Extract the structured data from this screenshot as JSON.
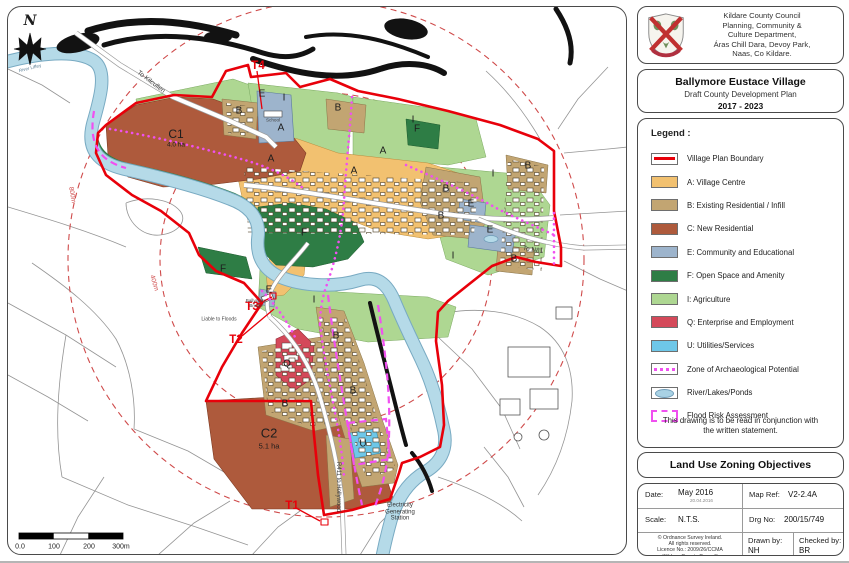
{
  "header": {
    "line1": "Kildare County Council",
    "line2": "Planning, Community &",
    "line3": "Culture Department,",
    "line4": "Áras Chill Dara, Devoy Park,",
    "line5": "Naas, Co Kildare."
  },
  "title_block": {
    "title": "Ballymore Eustace Village",
    "subtitle": "Draft County Development Plan",
    "years": "2017 - 2023"
  },
  "legend": {
    "heading": "Legend :",
    "items": [
      {
        "label": "Village Plan Boundary",
        "type": "boundary"
      },
      {
        "label": "A:  Village Centre",
        "color": "#f2c170"
      },
      {
        "label": "B:  Existing Residential / Infill",
        "color": "#c2a572"
      },
      {
        "label": "C:  New Residential",
        "color": "#ae5a3c"
      },
      {
        "label": "E:  Community and Educational",
        "color": "#9db4cc"
      },
      {
        "label": "F:  Open Space and Amenity",
        "color": "#2e7d45"
      },
      {
        "label": "I:  Agriculture",
        "color": "#aed792"
      },
      {
        "label": "Q:  Enterprise and Employment",
        "color": "#d4495a"
      },
      {
        "label": "U: Utilities/Services",
        "color": "#6ec7e8"
      },
      {
        "label": "Zone of Archaeological Potential",
        "type": "archaeo"
      },
      {
        "label": "River/Lakes/Ponds",
        "type": "river"
      },
      {
        "label": "Flood Risk Assessment",
        "type": "flood"
      }
    ],
    "note_line1": "This drawing is to be read in conjunction with",
    "note_line2": "the written statement."
  },
  "zoning_title": "Land Use Zoning Objectives",
  "info_table": {
    "date_label": "Date:",
    "date_value": "May 2016",
    "date_small": "20.04.2016",
    "mapref_label": "Map Ref:",
    "mapref_value": "V2-2.4A",
    "scale_label": "Scale:",
    "scale_value": "N.T.S.",
    "drgno_label": "Drg No:",
    "drgno_value": "200/15/749",
    "copyright_line1": "© Ordnance Survey Ireland.",
    "copyright_line2": "All rights reserved.",
    "copyright_line3": "Licence No.: 2009/26/CCMA",
    "copyright_line4": "(Kildare County Council)",
    "drawnby_label": "Drawn by:",
    "drawnby_value": "NH",
    "checkedby_label": "Checked by:",
    "checkedby_value": "BR"
  },
  "map": {
    "compass": "N",
    "labels": {
      "zone_a": "A",
      "zone_b": "B",
      "zone_e": "E",
      "zone_f": "F",
      "zone_i": "I",
      "zone_q": "Q",
      "zone_u": "U",
      "c1": "C1",
      "c1_area": "4.0 ha",
      "c2": "C2",
      "c2_area": "5.1 ha",
      "t1": "T1",
      "t2": "T2",
      "t3": "T3",
      "t4": "T4",
      "to_kilcullen": "To Kilcullen",
      "to_n81": "To N81",
      "r411": "R411 to Hollywood",
      "egs_line1": "Electricity",
      "egs_line2": "Generating",
      "egs_line3": "Station",
      "liable_to_floods": "Liable to Floods",
      "bridge_line1": "Ballymore",
      "bridge_line2": "Bridge",
      "school": "School",
      "river_liffey": "River Liffey",
      "radius_400": "400m",
      "radius_800": "800m"
    },
    "scalebar": {
      "t0": "0.0",
      "t100": "100",
      "t200": "200",
      "t300": "300m"
    }
  },
  "colors": {
    "boundary_red": "#e8000a",
    "archaeo_magenta": "#f050f0",
    "river_blue": "#b5dae8",
    "radius_circle_red": "#cf4a4a"
  }
}
